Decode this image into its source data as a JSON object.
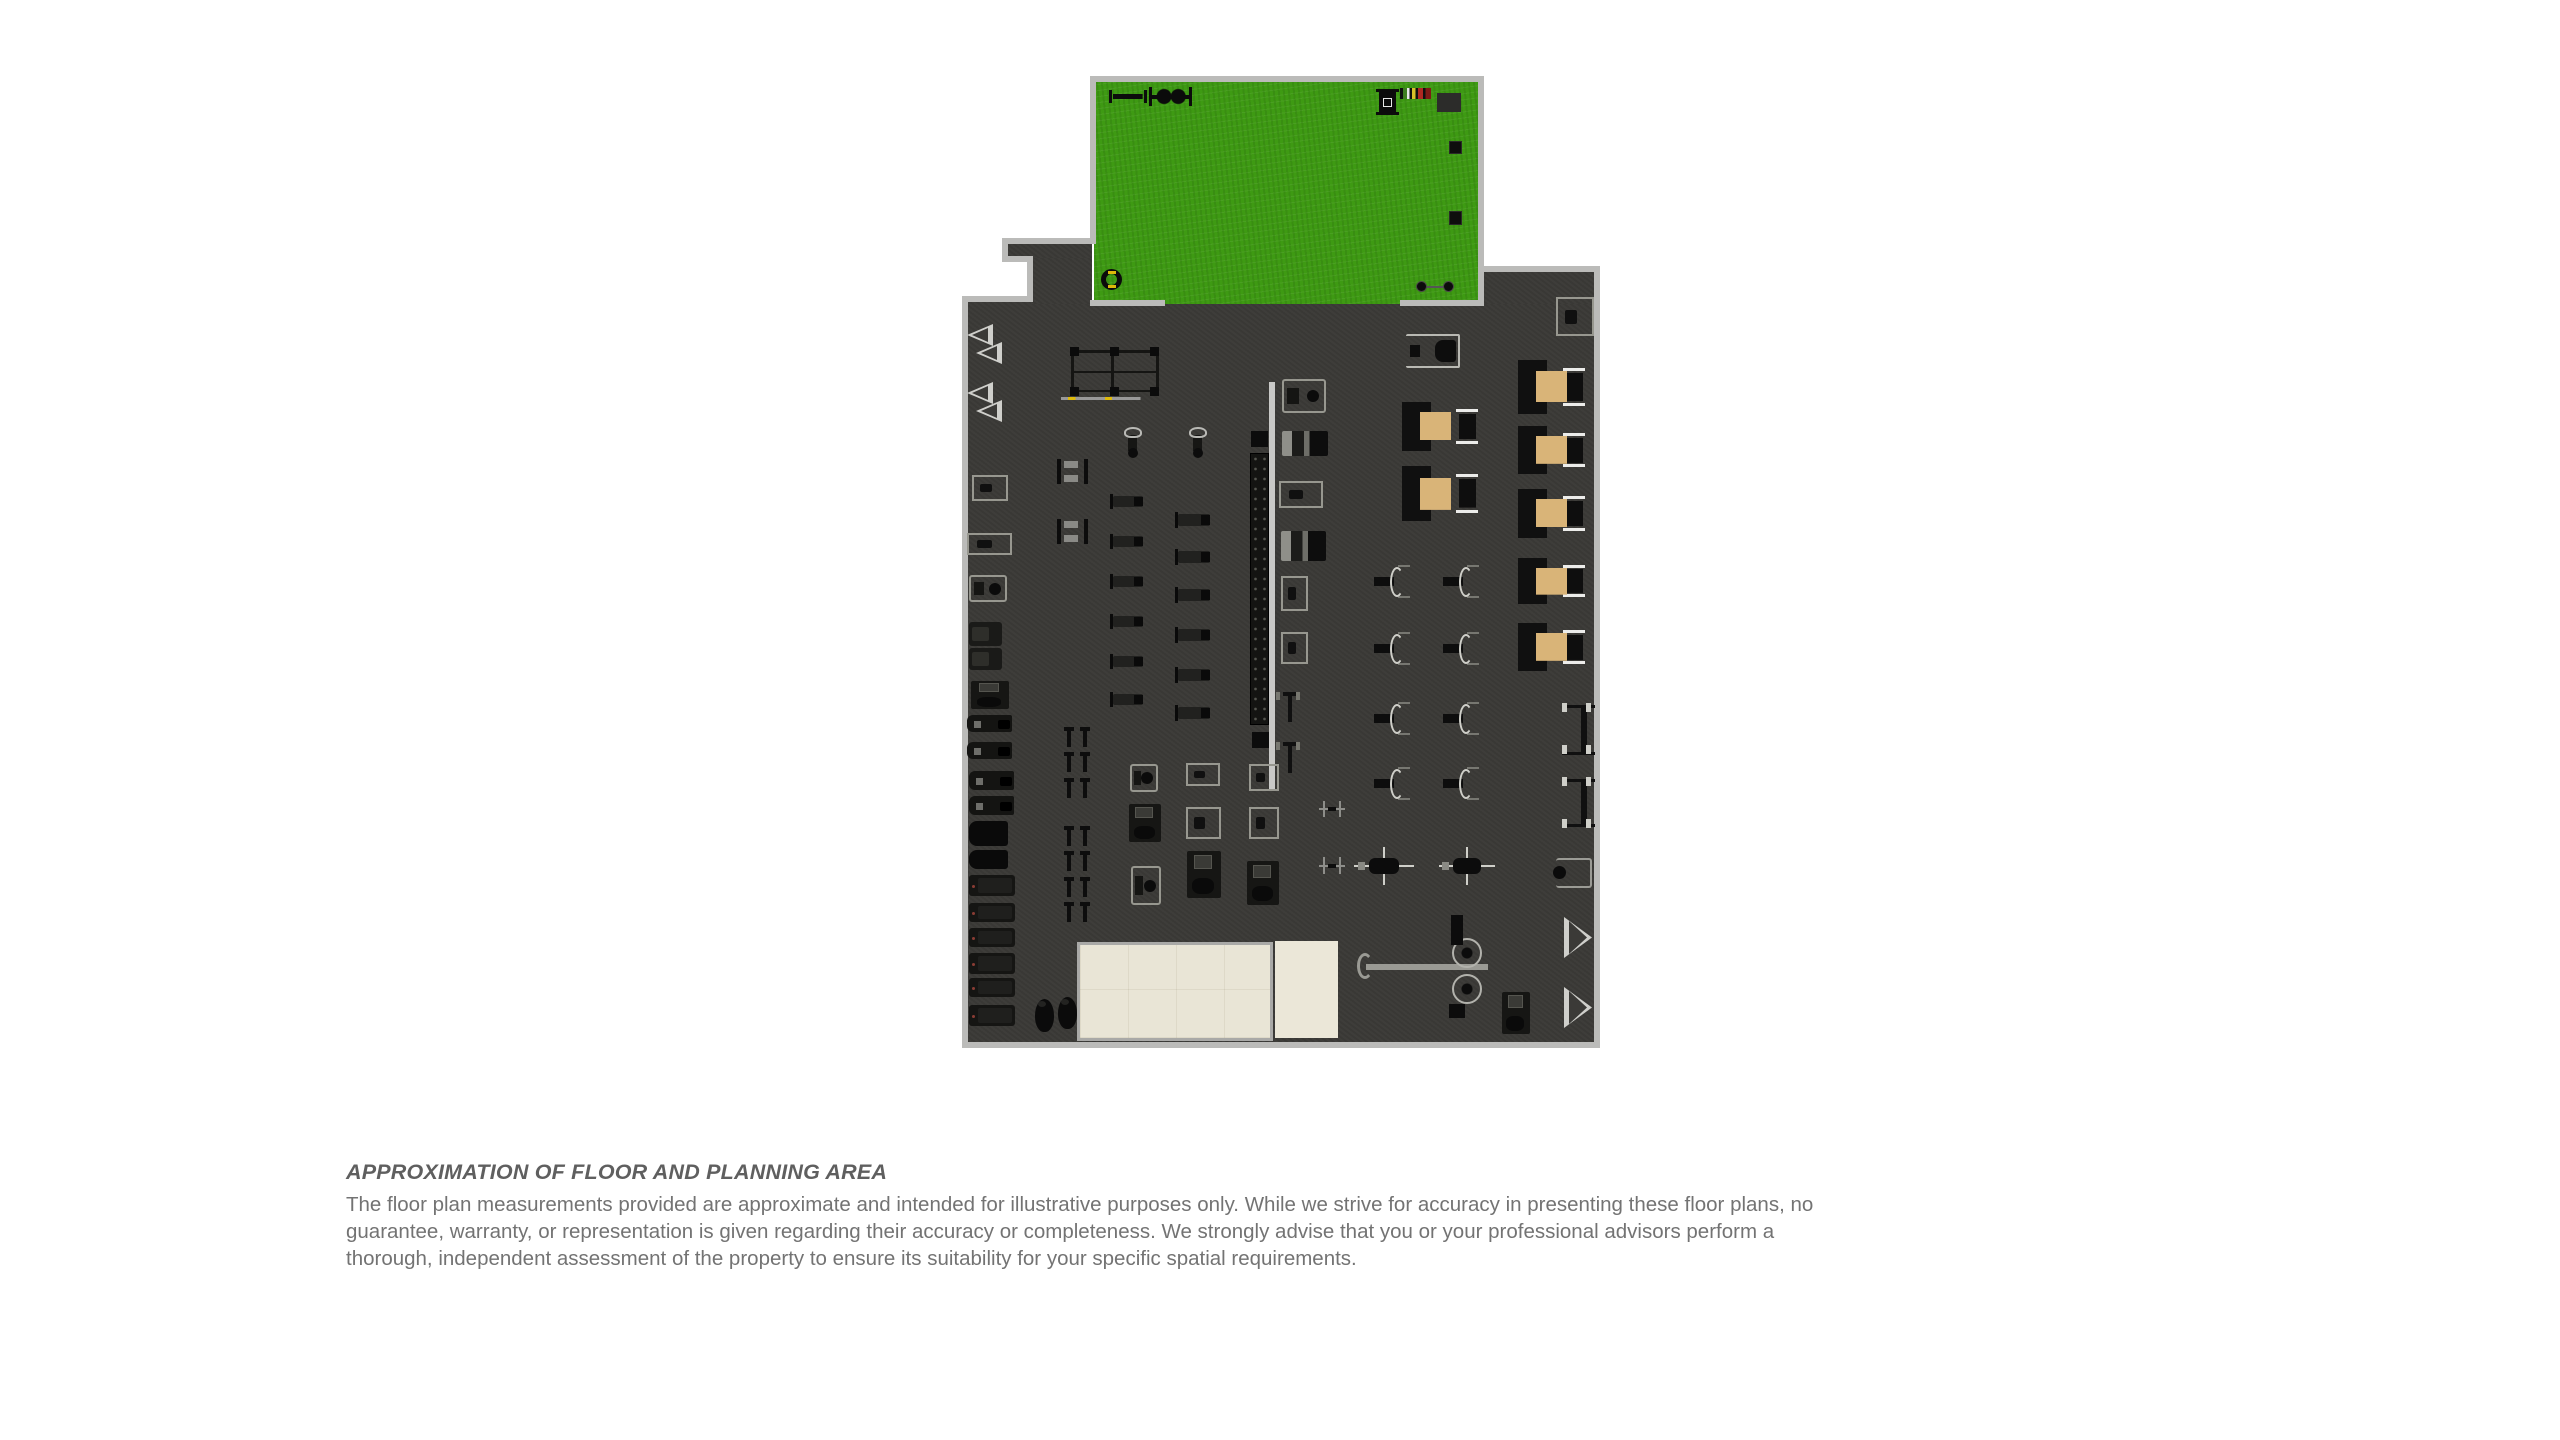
{
  "disclaimer": {
    "title": "APPROXIMATION OF FLOOR AND PLANNING AREA",
    "body": "The floor plan measurements provided are approximate and intended for illustrative purposes only. While we strive for accuracy in presenting these floor plans, no\nguarantee, warranty, or representation is given regarding their accuracy or completeness. We strongly advise that you or your professional advisors perform a\nthorough, independent assessment of the property to ensure its suitability for your specific spatial requirements."
  },
  "floor_plan": {
    "colors": {
      "floor": "#3b3a37",
      "wall": "#bbbbb9",
      "turf": "#3e9a13",
      "tan": "#d9b478",
      "beige": "#e9e5d6",
      "beigeBorder": "#a9a9a7",
      "mirror": "#c9c9c7",
      "machine": "#97978f",
      "yellow": "#ddb90a",
      "titleColor": "#5f5f5f",
      "bodyColor": "#737373"
    },
    "rects": [
      {
        "n": "gym-floor",
        "t": "fl-gym",
        "x": 966,
        "y": 300,
        "w": 630,
        "h": 744
      },
      {
        "n": "corridor-floor",
        "t": "fl-gym",
        "x": 1006,
        "y": 242,
        "w": 86,
        "h": 20
      },
      {
        "n": "corridor-floor",
        "t": "fl-gym",
        "x": 1031,
        "y": 258,
        "w": 61,
        "h": 46
      },
      {
        "n": "gym-floor-upper-right",
        "t": "fl-gym",
        "x": 1482,
        "y": 270,
        "w": 114,
        "h": 34
      },
      {
        "n": "turf-area",
        "t": "fl-turf",
        "x": 1094,
        "y": 80,
        "w": 386,
        "h": 224
      },
      {
        "n": "mat-room",
        "t": "fl-tile",
        "x": 1077,
        "y": 942,
        "w": 196,
        "h": 99
      },
      {
        "n": "studio-area",
        "t": "fl-beige",
        "x": 1275,
        "y": 941,
        "w": 63,
        "h": 97
      },
      {
        "n": "wall",
        "t": "wall",
        "x": 1090,
        "y": 76,
        "w": 394,
        "h": 6
      },
      {
        "n": "wall",
        "t": "wall",
        "x": 1090,
        "y": 76,
        "w": 6,
        "h": 168
      },
      {
        "n": "wall",
        "t": "wall",
        "x": 1478,
        "y": 76,
        "w": 6,
        "h": 230
      },
      {
        "n": "wall",
        "t": "wall",
        "x": 1090,
        "y": 300,
        "w": 75,
        "h": 6
      },
      {
        "n": "wall",
        "t": "wall",
        "x": 1400,
        "y": 300,
        "w": 84,
        "h": 6
      },
      {
        "n": "wall",
        "t": "wall",
        "x": 1002,
        "y": 238,
        "w": 94,
        "h": 6
      },
      {
        "n": "wall",
        "t": "wall",
        "x": 1002,
        "y": 238,
        "w": 6,
        "h": 24
      },
      {
        "n": "wall",
        "t": "wall",
        "x": 1002,
        "y": 256,
        "w": 31,
        "h": 6
      },
      {
        "n": "wall",
        "t": "wall",
        "x": 1027,
        "y": 256,
        "w": 6,
        "h": 46
      },
      {
        "n": "wall",
        "t": "wall",
        "x": 962,
        "y": 296,
        "w": 71,
        "h": 6
      },
      {
        "n": "wall",
        "t": "wall",
        "x": 962,
        "y": 296,
        "w": 6,
        "h": 752
      },
      {
        "n": "wall",
        "t": "wall",
        "x": 962,
        "y": 1042,
        "w": 638,
        "h": 6
      },
      {
        "n": "wall",
        "t": "wall",
        "x": 1594,
        "y": 266,
        "w": 6,
        "h": 782
      },
      {
        "n": "wall",
        "t": "wall",
        "x": 1482,
        "y": 266,
        "w": 118,
        "h": 6
      }
    ],
    "items": [
      {
        "n": "push-sled-icon",
        "t": "sled1",
        "x": 1109,
        "y": 90,
        "w": 38,
        "h": 13
      },
      {
        "n": "power-sled-icon",
        "t": "sled2",
        "x": 1149,
        "y": 86,
        "w": 43,
        "h": 21
      },
      {
        "n": "sled-rack-icon",
        "t": "minirack",
        "x": 1379,
        "y": 89,
        "w": 17,
        "h": 26
      },
      {
        "n": "bumper-plate-rack-icon",
        "t": "platerack",
        "x": 1400,
        "y": 88,
        "w": 31,
        "h": 11
      },
      {
        "n": "gym-mat-icon",
        "t": "mat",
        "x": 1437,
        "y": 93,
        "w": 24,
        "h": 19
      },
      {
        "n": "plyo-box-icon",
        "t": "plyo",
        "x": 1449,
        "y": 141,
        "w": 13,
        "h": 13
      },
      {
        "n": "plyo-box-icon",
        "t": "plyo",
        "x": 1449,
        "y": 211,
        "w": 13,
        "h": 14
      },
      {
        "n": "tire-icon",
        "t": "tire",
        "x": 1101,
        "y": 269,
        "w": 21,
        "h": 21
      },
      {
        "n": "barbell-icon",
        "t": "minibar",
        "x": 1416,
        "y": 281,
        "w": 38,
        "h": 11
      },
      {
        "n": "vent-triangle-icon",
        "t": "tri-l",
        "x": 967,
        "y": 324,
        "w": 26,
        "h": 22
      },
      {
        "n": "vent-triangle-icon",
        "t": "tri-l",
        "x": 976,
        "y": 342,
        "w": 26,
        "h": 22
      },
      {
        "n": "vent-triangle-icon",
        "t": "tri-l",
        "x": 967,
        "y": 382,
        "w": 26,
        "h": 22
      },
      {
        "n": "vent-triangle-icon",
        "t": "tri-l",
        "x": 976,
        "y": 400,
        "w": 26,
        "h": 22
      },
      {
        "n": "adjustable-bench-icon",
        "t": "mlight",
        "x": 972,
        "y": 475,
        "w": 36,
        "h": 26
      },
      {
        "n": "weight-machine-icon",
        "t": "mlight",
        "x": 967,
        "y": 533,
        "w": 45,
        "h": 22
      },
      {
        "n": "seated-machine-icon",
        "t": "mseat",
        "x": 969,
        "y": 575,
        "w": 38,
        "h": 27
      },
      {
        "n": "cardio-machine-icon",
        "t": "mdark",
        "x": 969,
        "y": 622,
        "w": 33,
        "h": 24
      },
      {
        "n": "cardio-machine-icon",
        "t": "mdark",
        "x": 969,
        "y": 648,
        "w": 33,
        "h": 22
      },
      {
        "n": "weight-machine-icon",
        "t": "mdark2",
        "x": 971,
        "y": 681,
        "w": 38,
        "h": 28
      },
      {
        "n": "rowing-machine-icon",
        "t": "rower",
        "x": 967,
        "y": 715,
        "w": 45,
        "h": 17
      },
      {
        "n": "rowing-machine-icon",
        "t": "rower",
        "x": 967,
        "y": 742,
        "w": 45,
        "h": 17
      },
      {
        "n": "rowing-machine-icon",
        "t": "rower",
        "x": 969,
        "y": 771,
        "w": 45,
        "h": 19
      },
      {
        "n": "rowing-machine-icon",
        "t": "rower",
        "x": 969,
        "y": 796,
        "w": 45,
        "h": 19
      },
      {
        "n": "storage-box-icon",
        "t": "blackbox",
        "x": 969,
        "y": 821,
        "w": 39,
        "h": 25
      },
      {
        "n": "storage-box-icon",
        "t": "blackbox",
        "x": 969,
        "y": 850,
        "w": 39,
        "h": 19
      },
      {
        "n": "treadmill-icon",
        "t": "treadmill",
        "x": 969,
        "y": 875,
        "w": 46,
        "h": 21
      },
      {
        "n": "treadmill-icon",
        "t": "treadmill",
        "x": 969,
        "y": 903,
        "w": 46,
        "h": 19
      },
      {
        "n": "treadmill-icon",
        "t": "treadmill",
        "x": 969,
        "y": 928,
        "w": 46,
        "h": 19
      },
      {
        "n": "treadmill-icon",
        "t": "treadmill",
        "x": 969,
        "y": 953,
        "w": 46,
        "h": 21
      },
      {
        "n": "treadmill-icon",
        "t": "treadmill",
        "x": 969,
        "y": 978,
        "w": 46,
        "h": 19
      },
      {
        "n": "treadmill-icon",
        "t": "treadmill",
        "x": 969,
        "y": 1005,
        "w": 46,
        "h": 21
      },
      {
        "n": "punching-bag-icon",
        "t": "bag",
        "x": 1035,
        "y": 999,
        "w": 19,
        "h": 33
      },
      {
        "n": "punching-bag-icon",
        "t": "bag",
        "x": 1058,
        "y": 997,
        "w": 19,
        "h": 32
      },
      {
        "n": "squat-rack-icon",
        "t": "rack",
        "x": 1071,
        "y": 350,
        "w": 88,
        "h": 54
      },
      {
        "n": "spin-bike-icon",
        "t": "bike",
        "x": 1117,
        "y": 427,
        "w": 31,
        "h": 31
      },
      {
        "n": "spin-bike-icon",
        "t": "bike",
        "x": 1182,
        "y": 427,
        "w": 31,
        "h": 31
      },
      {
        "n": "bench-station-icon",
        "t": "hbench",
        "x": 1057,
        "y": 459,
        "w": 31,
        "h": 25
      },
      {
        "n": "bench-station-icon",
        "t": "hbench",
        "x": 1057,
        "y": 519,
        "w": 31,
        "h": 25
      },
      {
        "n": "flat-bench-icon",
        "t": "flatbench",
        "x": 1113,
        "y": 496,
        "w": 30,
        "h": 11
      },
      {
        "n": "flat-bench-icon",
        "t": "flatbench",
        "x": 1113,
        "y": 536,
        "w": 30,
        "h": 11
      },
      {
        "n": "flat-bench-icon",
        "t": "flatbench",
        "x": 1113,
        "y": 576,
        "w": 30,
        "h": 11
      },
      {
        "n": "flat-bench-icon",
        "t": "flatbench",
        "x": 1113,
        "y": 616,
        "w": 30,
        "h": 11
      },
      {
        "n": "flat-bench-icon",
        "t": "flatbench",
        "x": 1113,
        "y": 656,
        "w": 30,
        "h": 11
      },
      {
        "n": "flat-bench-icon",
        "t": "flatbench",
        "x": 1113,
        "y": 694,
        "w": 30,
        "h": 11
      },
      {
        "n": "flat-bench-icon",
        "t": "flatbench",
        "x": 1178,
        "y": 514,
        "w": 32,
        "h": 12
      },
      {
        "n": "flat-bench-icon",
        "t": "flatbench",
        "x": 1178,
        "y": 551,
        "w": 32,
        "h": 12
      },
      {
        "n": "flat-bench-icon",
        "t": "flatbench",
        "x": 1178,
        "y": 589,
        "w": 32,
        "h": 12
      },
      {
        "n": "flat-bench-icon",
        "t": "flatbench",
        "x": 1178,
        "y": 629,
        "w": 32,
        "h": 12
      },
      {
        "n": "flat-bench-icon",
        "t": "flatbench",
        "x": 1178,
        "y": 669,
        "w": 32,
        "h": 12
      },
      {
        "n": "flat-bench-icon",
        "t": "flatbench",
        "x": 1178,
        "y": 707,
        "w": 32,
        "h": 12
      },
      {
        "n": "rack-end-icon",
        "t": "blacksq",
        "x": 1251,
        "y": 431,
        "w": 17,
        "h": 16
      },
      {
        "n": "dumbbell-rack-icon",
        "t": "dbrack",
        "x": 1250,
        "y": 453,
        "w": 19,
        "h": 272
      },
      {
        "n": "rack-end-icon",
        "t": "blacksq",
        "x": 1252,
        "y": 732,
        "w": 17,
        "h": 16
      },
      {
        "n": "mirror-wall",
        "t": "mirror",
        "x": 1269,
        "y": 382,
        "w": 6,
        "h": 408
      },
      {
        "n": "bench-pair-icon",
        "t": "tbar",
        "x": 1062,
        "y": 727,
        "w": 31,
        "h": 20
      },
      {
        "n": "bench-pair-icon",
        "t": "tbar",
        "x": 1062,
        "y": 752,
        "w": 31,
        "h": 20
      },
      {
        "n": "bench-pair-icon",
        "t": "tbar",
        "x": 1062,
        "y": 778,
        "w": 31,
        "h": 20
      },
      {
        "n": "bench-pair-icon",
        "t": "tbar",
        "x": 1062,
        "y": 826,
        "w": 31,
        "h": 20
      },
      {
        "n": "bench-pair-icon",
        "t": "tbar",
        "x": 1062,
        "y": 851,
        "w": 31,
        "h": 20
      },
      {
        "n": "bench-pair-icon",
        "t": "tbar",
        "x": 1062,
        "y": 877,
        "w": 31,
        "h": 20
      },
      {
        "n": "bench-pair-icon",
        "t": "tbar",
        "x": 1062,
        "y": 902,
        "w": 31,
        "h": 20
      },
      {
        "n": "seated-machine-icon",
        "t": "mseat",
        "x": 1130,
        "y": 764,
        "w": 28,
        "h": 28
      },
      {
        "n": "weight-machine-icon",
        "t": "mdark2",
        "x": 1129,
        "y": 804,
        "w": 32,
        "h": 38
      },
      {
        "n": "seated-machine-icon",
        "t": "mseat",
        "x": 1131,
        "y": 866,
        "w": 30,
        "h": 39
      },
      {
        "n": "weight-machine-icon",
        "t": "mlight",
        "x": 1186,
        "y": 763,
        "w": 34,
        "h": 23
      },
      {
        "n": "weight-machine-icon",
        "t": "mlight",
        "x": 1186,
        "y": 807,
        "w": 35,
        "h": 32
      },
      {
        "n": "weight-machine-icon",
        "t": "mdark2",
        "x": 1187,
        "y": 851,
        "w": 34,
        "h": 47
      },
      {
        "n": "weight-machine-icon",
        "t": "mlight",
        "x": 1249,
        "y": 764,
        "w": 30,
        "h": 27
      },
      {
        "n": "weight-machine-icon",
        "t": "mlight",
        "x": 1249,
        "y": 807,
        "w": 30,
        "h": 32
      },
      {
        "n": "weight-machine-icon",
        "t": "mdark2",
        "x": 1247,
        "y": 861,
        "w": 32,
        "h": 44
      },
      {
        "n": "lat-pulldown-icon",
        "t": "mseat",
        "x": 1282,
        "y": 379,
        "w": 44,
        "h": 34
      },
      {
        "n": "weight-stack-machine-icon",
        "t": "mstack",
        "x": 1282,
        "y": 431,
        "w": 46,
        "h": 25
      },
      {
        "n": "weight-machine-icon",
        "t": "mlight",
        "x": 1279,
        "y": 481,
        "w": 44,
        "h": 27
      },
      {
        "n": "weight-stack-machine-icon",
        "t": "mstack",
        "x": 1281,
        "y": 531,
        "w": 45,
        "h": 30
      },
      {
        "n": "weight-machine-icon",
        "t": "mlight",
        "x": 1281,
        "y": 576,
        "w": 27,
        "h": 35
      },
      {
        "n": "weight-machine-icon",
        "t": "mlight",
        "x": 1281,
        "y": 632,
        "w": 27,
        "h": 32
      },
      {
        "n": "cable-station-icon",
        "t": "tsingle",
        "x": 1276,
        "y": 692,
        "w": 28,
        "h": 30
      },
      {
        "n": "cable-station-icon",
        "t": "tsingle",
        "x": 1276,
        "y": 742,
        "w": 28,
        "h": 31
      },
      {
        "n": "pulley-machine-icon",
        "t": "crosssm",
        "x": 1319,
        "y": 801,
        "w": 26,
        "h": 16
      },
      {
        "n": "pulley-machine-icon",
        "t": "crosssm",
        "x": 1319,
        "y": 857,
        "w": 26,
        "h": 17
      },
      {
        "n": "plate-loaded-machine-icon",
        "t": "gridmach",
        "x": 1374,
        "y": 560,
        "w": 43,
        "h": 43
      },
      {
        "n": "plate-loaded-machine-icon",
        "t": "gridmach",
        "x": 1443,
        "y": 560,
        "w": 43,
        "h": 43
      },
      {
        "n": "plate-loaded-machine-icon",
        "t": "gridmach",
        "x": 1374,
        "y": 627,
        "w": 43,
        "h": 43
      },
      {
        "n": "plate-loaded-machine-icon",
        "t": "gridmach",
        "x": 1443,
        "y": 627,
        "w": 43,
        "h": 43
      },
      {
        "n": "plate-loaded-machine-icon",
        "t": "gridmach",
        "x": 1374,
        "y": 697,
        "w": 43,
        "h": 43
      },
      {
        "n": "plate-loaded-machine-icon",
        "t": "gridmach",
        "x": 1443,
        "y": 697,
        "w": 43,
        "h": 43
      },
      {
        "n": "plate-loaded-machine-icon",
        "t": "gridmach",
        "x": 1374,
        "y": 762,
        "w": 43,
        "h": 43
      },
      {
        "n": "plate-loaded-machine-icon",
        "t": "gridmach",
        "x": 1443,
        "y": 762,
        "w": 43,
        "h": 43
      },
      {
        "n": "pad-bench-icon",
        "t": "padbench",
        "x": 1406,
        "y": 334,
        "w": 54,
        "h": 34
      },
      {
        "n": "corner-machine-icon",
        "t": "mlight",
        "x": 1556,
        "y": 297,
        "w": 38,
        "h": 39
      },
      {
        "n": "platform-machine-icon",
        "t": "tanbench",
        "x": 1402,
        "y": 402,
        "w": 76,
        "h": 49
      },
      {
        "n": "platform-machine-icon",
        "t": "tanbench",
        "x": 1402,
        "y": 466,
        "w": 76,
        "h": 55
      },
      {
        "n": "platform-machine-icon",
        "t": "tanbench",
        "x": 1518,
        "y": 360,
        "w": 67,
        "h": 54
      },
      {
        "n": "platform-machine-icon",
        "t": "tanbench",
        "x": 1518,
        "y": 426,
        "w": 67,
        "h": 48
      },
      {
        "n": "platform-machine-icon",
        "t": "tanbench",
        "x": 1518,
        "y": 489,
        "w": 67,
        "h": 49
      },
      {
        "n": "platform-machine-icon",
        "t": "tanbench",
        "x": 1518,
        "y": 558,
        "w": 67,
        "h": 46
      },
      {
        "n": "platform-machine-icon",
        "t": "tanbench",
        "x": 1518,
        "y": 623,
        "w": 67,
        "h": 48
      },
      {
        "n": "half-rack-icon",
        "t": "halfrack",
        "x": 1562,
        "y": 705,
        "w": 33,
        "h": 50
      },
      {
        "n": "half-rack-icon",
        "t": "halfrack",
        "x": 1562,
        "y": 779,
        "w": 33,
        "h": 48
      },
      {
        "n": "ball-machine-icon",
        "t": "mball",
        "x": 1556,
        "y": 858,
        "w": 36,
        "h": 30
      },
      {
        "n": "press-machine-icon",
        "t": "mwide",
        "x": 1354,
        "y": 847,
        "w": 60,
        "h": 38
      },
      {
        "n": "press-machine-icon",
        "t": "mwide",
        "x": 1439,
        "y": 847,
        "w": 56,
        "h": 38
      },
      {
        "n": "vent-triangle-icon",
        "t": "tri-r",
        "x": 1564,
        "y": 917,
        "w": 28,
        "h": 41
      },
      {
        "n": "vent-triangle-icon",
        "t": "tri-r",
        "x": 1564,
        "y": 987,
        "w": 28,
        "h": 41
      },
      {
        "n": "small-machine-icon",
        "t": "mdark2",
        "x": 1502,
        "y": 992,
        "w": 28,
        "h": 42
      },
      {
        "n": "cable-crossover-bar-icon",
        "t": "crossbar",
        "x": 1366,
        "y": 964,
        "w": 122,
        "h": 6
      },
      {
        "n": "cable-crossover-pulleys-icon",
        "t": "gears",
        "x": 1444,
        "y": 936,
        "w": 46,
        "h": 70
      },
      {
        "n": "crossover-post-icon",
        "t": "blacksq",
        "x": 1451,
        "y": 915,
        "w": 12,
        "h": 30
      },
      {
        "n": "crossover-base-icon",
        "t": "blacksq",
        "x": 1449,
        "y": 1004,
        "w": 16,
        "h": 14
      }
    ]
  }
}
